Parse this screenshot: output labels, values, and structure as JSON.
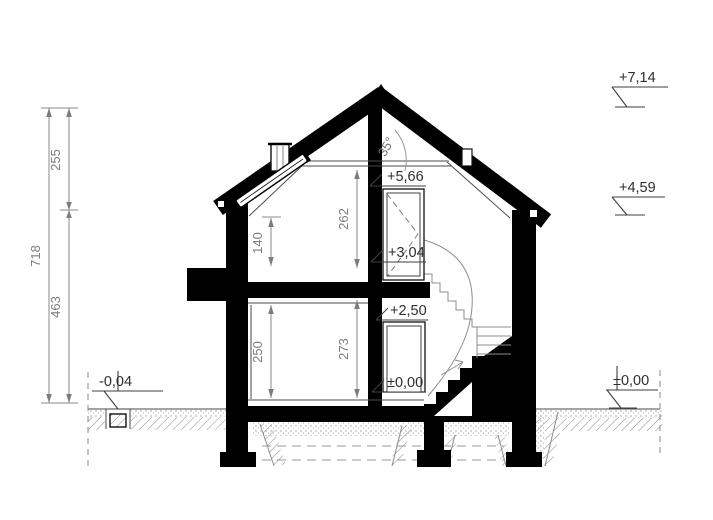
{
  "drawing": {
    "angle": "35°",
    "dims": {
      "total": "718",
      "roof_zone": "255",
      "wall_zone": "463",
      "attic_room": "262",
      "knee_wall": "140",
      "ground_room": "250",
      "ground_struct": "273"
    },
    "levels": {
      "ridge": "+7,14",
      "eaves": "+4,59",
      "grade_right": "±0,00",
      "grade_left": "-0,04",
      "attic_top": "+5,66",
      "landing": "+3,04",
      "first_floor": "+2,50",
      "ground_floor": "±0,00"
    }
  }
}
